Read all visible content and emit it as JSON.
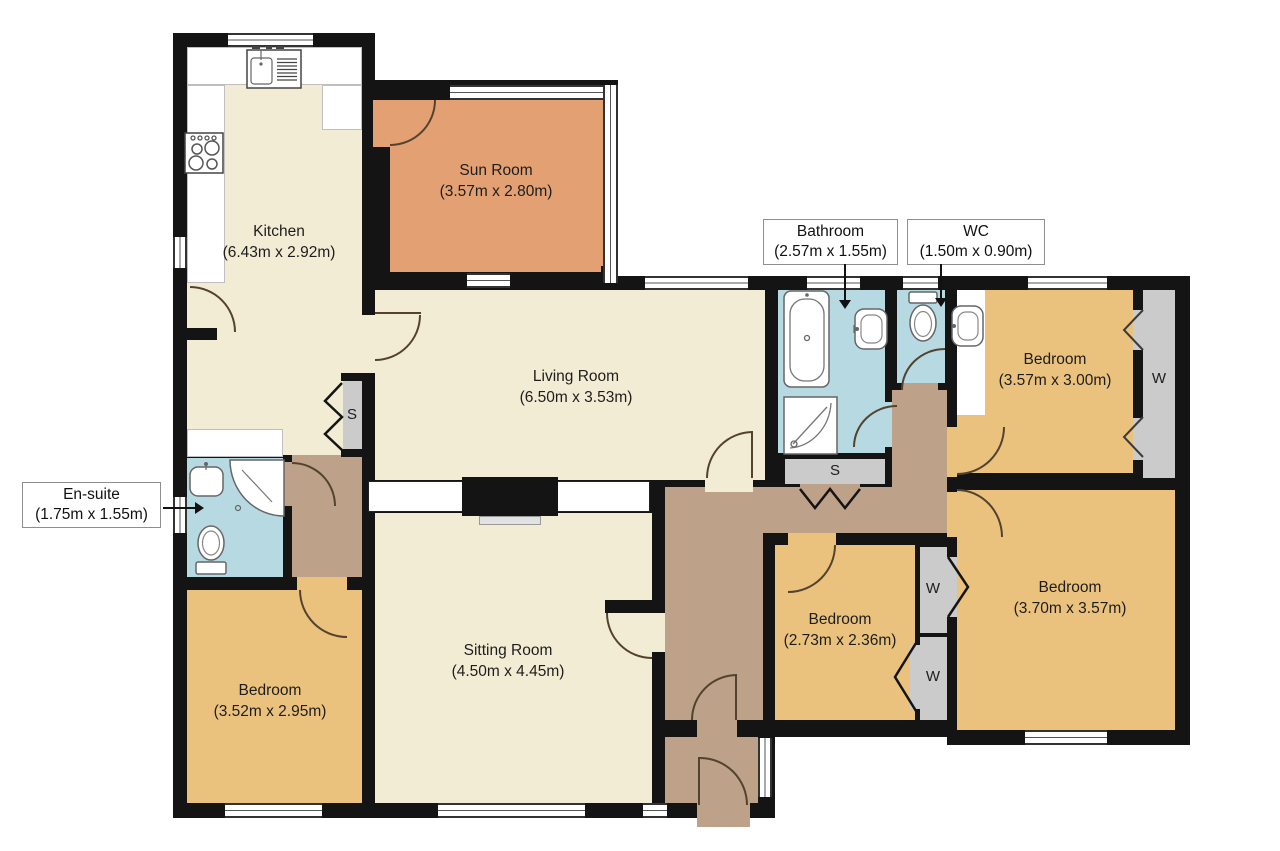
{
  "plan": {
    "rooms": [
      {
        "key": "kitchen",
        "name": "Kitchen",
        "dims": "(6.43m x 2.92m)"
      },
      {
        "key": "sun-room",
        "name": "Sun Room",
        "dims": "(3.57m x 2.80m)"
      },
      {
        "key": "living-room",
        "name": "Living Room",
        "dims": "(6.50m x 3.53m)"
      },
      {
        "key": "sitting-room",
        "name": "Sitting Room",
        "dims": "(4.50m x 4.45m)"
      },
      {
        "key": "bedroom-left",
        "name": "Bedroom",
        "dims": "(3.52m x 2.95m)"
      },
      {
        "key": "bedroom-top-right",
        "name": "Bedroom",
        "dims": "(3.57m x 3.00m)"
      },
      {
        "key": "bedroom-middle",
        "name": "Bedroom",
        "dims": "(2.73m x 2.36m)"
      },
      {
        "key": "bedroom-bottom-right",
        "name": "Bedroom",
        "dims": "(3.70m x 3.57m)"
      }
    ],
    "callouts": [
      {
        "key": "bathroom",
        "name": "Bathroom",
        "dims": "(2.57m x 1.55m)"
      },
      {
        "key": "wc",
        "name": "WC",
        "dims": "(1.50m x 0.90m)"
      },
      {
        "key": "en-suite",
        "name": "En-suite",
        "dims": "(1.75m x 1.55m)"
      }
    ],
    "markers": {
      "storage": "S",
      "wardrobe": "W"
    },
    "colors": {
      "wall": "#141414",
      "floor_cream": "#f3ecd5",
      "floor_orange": "#e3a173",
      "floor_tan": "#eac27d",
      "floor_blue": "#b7dae2",
      "floor_hall": "#bda189",
      "cupboard_gray": "#cbcbcb"
    }
  }
}
